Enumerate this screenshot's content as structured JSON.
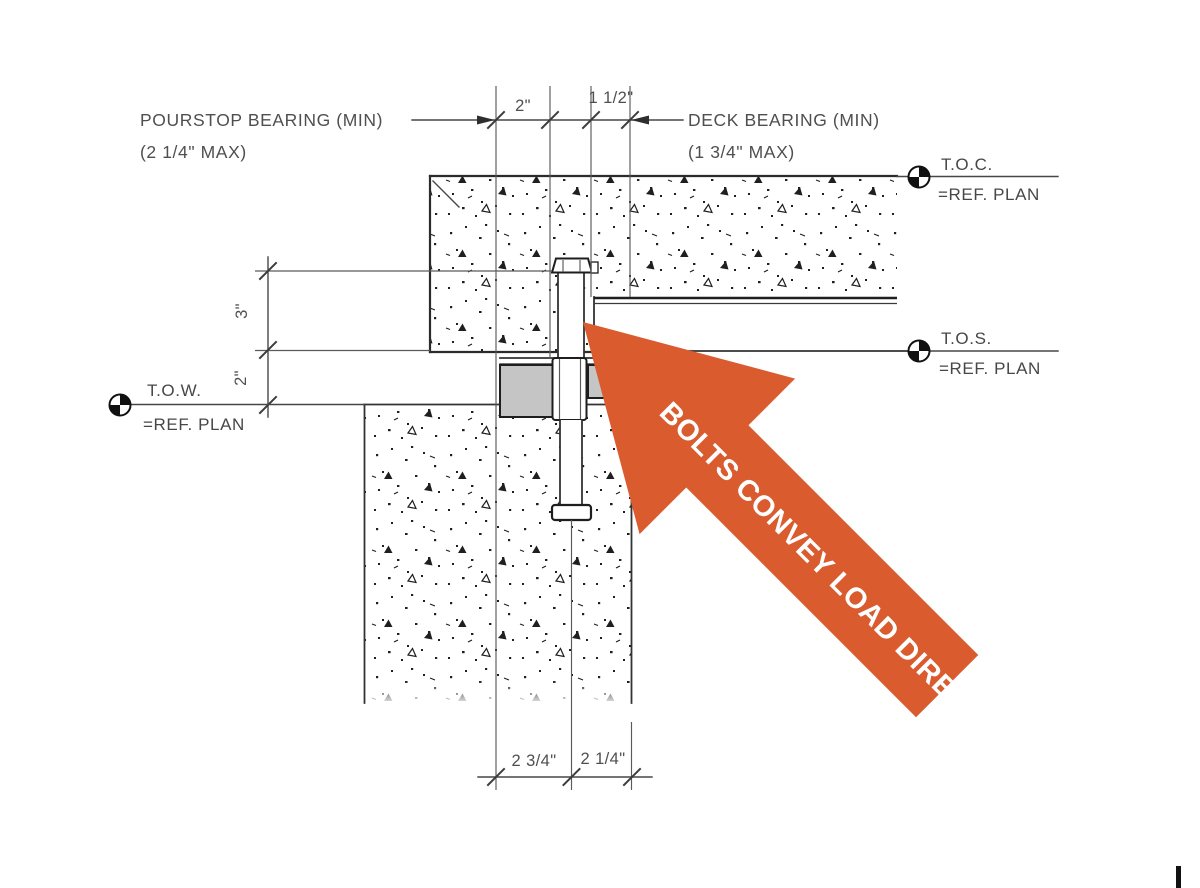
{
  "drawing": {
    "notes": {
      "pourstop": {
        "line1": "POURSTOP BEARING (MIN)",
        "line2": "(2 1/4\" MAX)"
      },
      "deck": {
        "line1": "DECK BEARING (MIN)",
        "line2": "(1 3/4\" MAX)"
      }
    },
    "dimensions": {
      "top_pourstop_bearing": "2\"",
      "top_deck_bearing": "1 1/2\"",
      "side_upper": "3\"",
      "side_lower": "2\"",
      "bottom_left": "2 3/4\"",
      "bottom_right": "2 1/4\""
    },
    "elevations": {
      "toc": {
        "label": "T.O.C.",
        "ref": "=REF. PLAN"
      },
      "tos": {
        "label": "T.O.S.",
        "ref": "=REF. PLAN"
      },
      "tow": {
        "label": "T.O.W.",
        "ref": "=REF. PLAN"
      }
    }
  },
  "annotation": {
    "arrow_text": "BOLTS CONVEY LOAD DIRECTLY",
    "arrow_color": "#D95B2E",
    "text_color": "#FFFFFF"
  },
  "colors": {
    "line": "#3c3c3c",
    "plate_gray": "#C5C5C5",
    "background": "#FFFFFF"
  }
}
